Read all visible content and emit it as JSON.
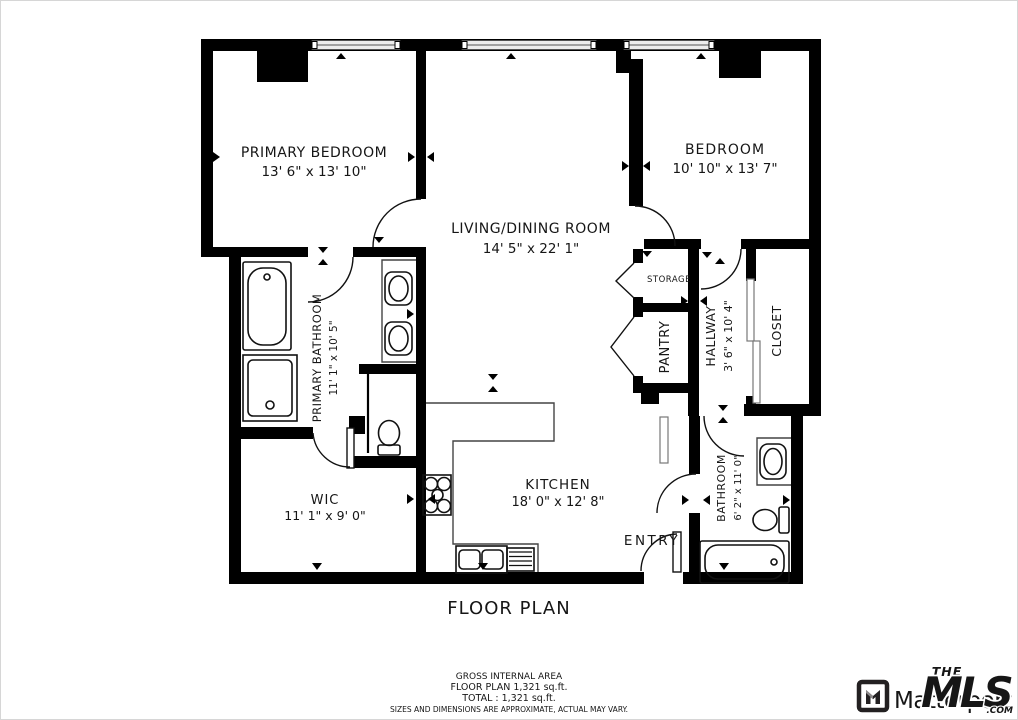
{
  "title": "FLOOR PLAN",
  "rooms": {
    "primary_bedroom": {
      "name": "PRIMARY BEDROOM",
      "dims": "13' 6\" x 13' 10\""
    },
    "living_dining": {
      "name": "LIVING/DINING ROOM",
      "dims": "14' 5\" x 22' 1\""
    },
    "bedroom": {
      "name": "BEDROOM",
      "dims": "10' 10\" x 13' 7\""
    },
    "kitchen": {
      "name": "KITCHEN",
      "dims": "18' 0\" x 12' 8\""
    },
    "wic": {
      "name": "WIC",
      "dims": "11' 1\" x 9' 0\""
    },
    "primary_bathroom": {
      "name": "PRIMARY BATHROOM",
      "dims": "11' 1\" x 10' 5\""
    },
    "bathroom": {
      "name": "BATHROOM",
      "dims": "6' 2\" x 11' 0\""
    },
    "hallway": {
      "name": "HALLWAY",
      "dims": "3' 6\" x 10' 4\""
    },
    "closet": {
      "name": "CLOSET"
    },
    "storage": {
      "name": "STORAGE"
    },
    "pantry": {
      "name": "PANTRY"
    },
    "entry": {
      "name": "ENTRY"
    }
  },
  "footer": {
    "line1": "GROSS INTERNAL AREA",
    "line2": "FLOOR PLAN 1,321 sq.ft.",
    "line3": "TOTAL :  1,321 sq.ft.",
    "disclaimer": "SIZES AND DIMENSIONS ARE APPROXIMATE, ACTUAL MAY VARY."
  },
  "branding": {
    "matterport": "Matterport",
    "mls_the": "THE",
    "mls": "MLS",
    "mls_tm": "™",
    "mls_com": ".COM",
    "mls_red": "#e0252a"
  }
}
